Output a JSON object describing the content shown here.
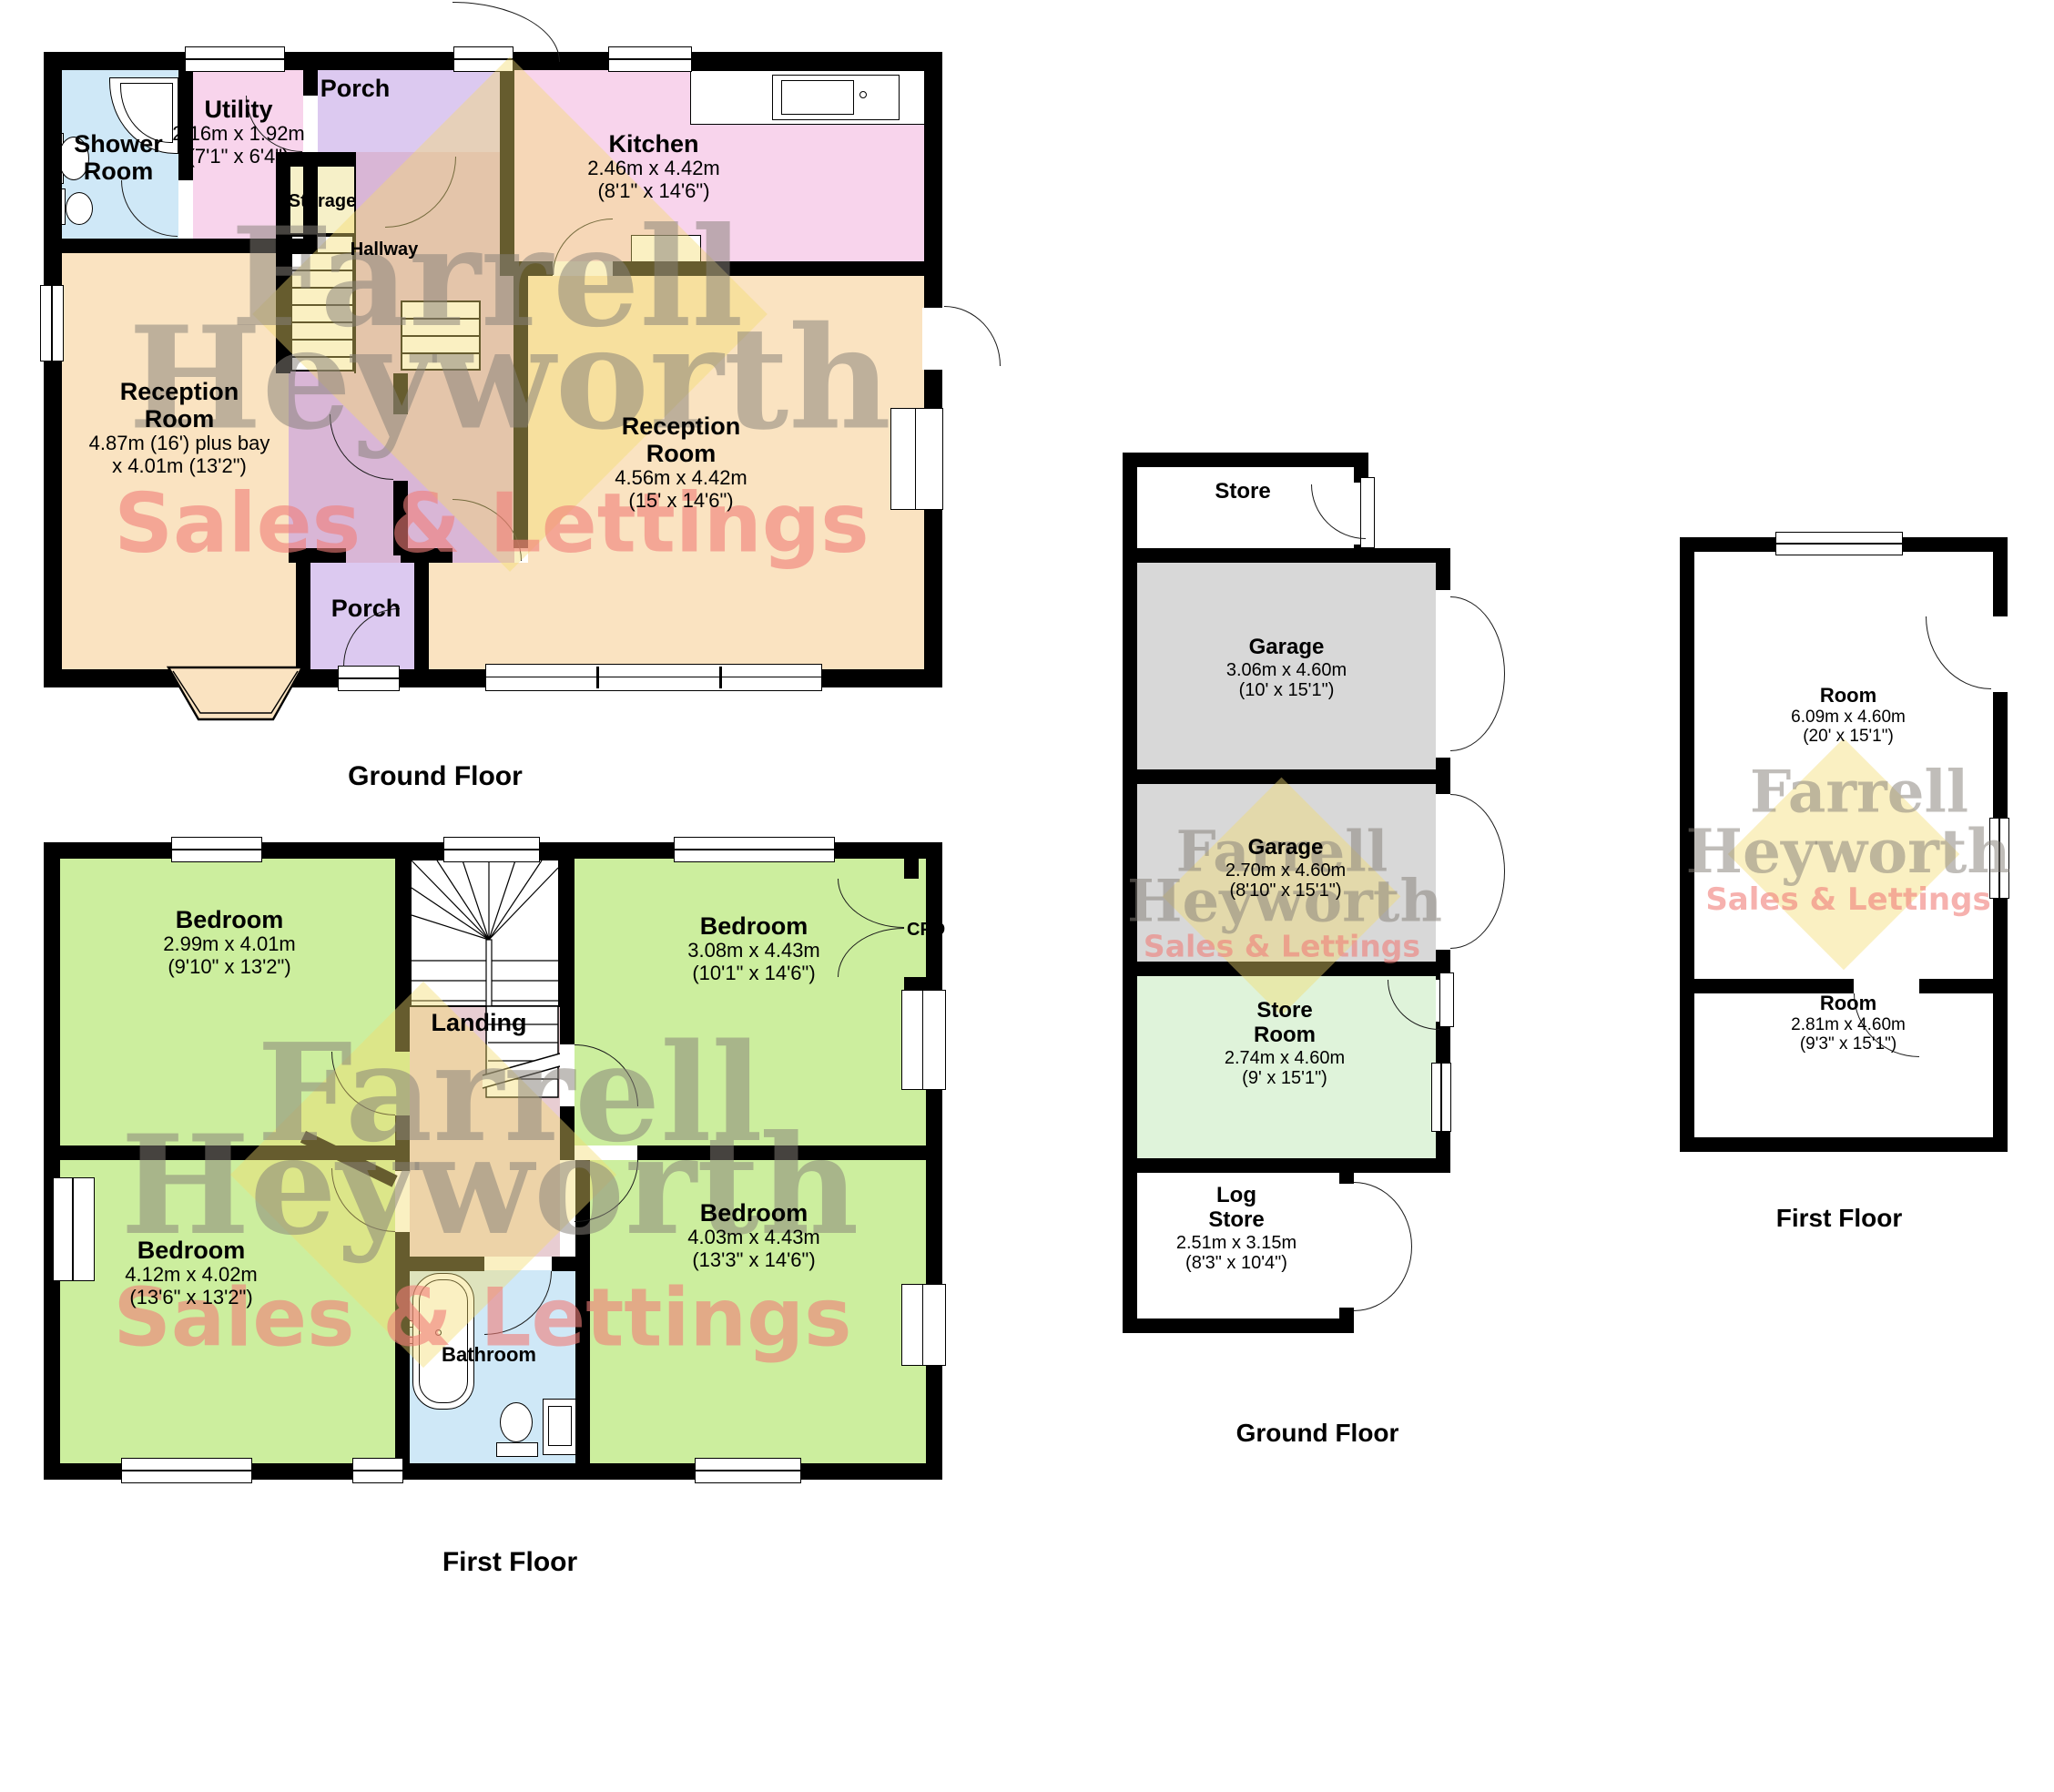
{
  "colors": {
    "wall": "#000000",
    "shower_bathroom": "#cfe8f7",
    "utility_kitchen": "#f8d4ec",
    "porch": "#dcc9f0",
    "hallway": "#d9b6d6",
    "landing": "#e8cdd2",
    "reception": "#fae3c1",
    "bedroom": "#ccee9e",
    "garage": "#d8d8d8",
    "store_room": "#dff3da",
    "storage": "#f6f0c8",
    "watermark_yellow": "#f3dc6f",
    "watermark_grey": "#8f8c86",
    "watermark_red": "#ef8d8d"
  },
  "watermark": {
    "l1": "Farrell",
    "l2": "Heyworth",
    "l3": "Sales & Lettings"
  },
  "hg": {
    "caption": "Ground Floor",
    "shower1": "Shower",
    "shower2": "Room",
    "utility": "Utility",
    "utility_m": "2.16m x 1.92m",
    "utility_f": "(7'1\" x 6'4\")",
    "porch_top": "Porch",
    "kitchen": "Kitchen",
    "kitchen_m": "2.46m x 4.42m",
    "kitchen_f": "(8'1\" x 14'6\")",
    "storage": "Storage",
    "hallway": "Hallway",
    "recl1": "Reception",
    "recl2": "Room",
    "recl_m": "4.87m (16') plus bay",
    "recl_f": "x 4.01m (13'2\")",
    "recr1": "Reception",
    "recr2": "Room",
    "recr_m": "4.56m x 4.42m",
    "recr_f": "(15' x 14'6\")",
    "porch_bottom": "Porch"
  },
  "hf": {
    "caption": "First Floor",
    "btl": "Bedroom",
    "btl_m": "2.99m x 4.01m",
    "btl_f": "(9'10\" x 13'2\")",
    "btr": "Bedroom",
    "btr_m": "3.08m x 4.43m",
    "btr_f": "(10'1\" x 14'6\")",
    "bbl": "Bedroom",
    "bbl_m": "4.12m x 4.02m",
    "bbl_f": "(13'6\" x 13'2\")",
    "bbr": "Bedroom",
    "bbr_m": "4.03m x 4.43m",
    "bbr_f": "(13'3\" x 14'6\")",
    "landing": "Landing",
    "bathroom": "Bathroom",
    "cpd": "CPD"
  },
  "og": {
    "caption": "Ground Floor",
    "store": "Store",
    "g1": "Garage",
    "g1_m": "3.06m x 4.60m",
    "g1_f": "(10' x 15'1\")",
    "g2": "Garage",
    "g2_m": "2.70m x 4.60m",
    "g2_f": "(8'10\" x 15'1\")",
    "sr1": "Store",
    "sr2": "Room",
    "sr_m": "2.74m x 4.60m",
    "sr_f": "(9' x 15'1\")",
    "ls1": "Log",
    "ls2": "Store",
    "ls_m": "2.51m x 3.15m",
    "ls_f": "(8'3\" x 10'4\")"
  },
  "of": {
    "caption": "First Floor",
    "rt": "Room",
    "rt_m": "6.09m x 4.60m",
    "rt_f": "(20' x 15'1\")",
    "rb": "Room",
    "rb_m": "2.81m x 4.60m",
    "rb_f": "(9'3\" x 15'1\")"
  }
}
